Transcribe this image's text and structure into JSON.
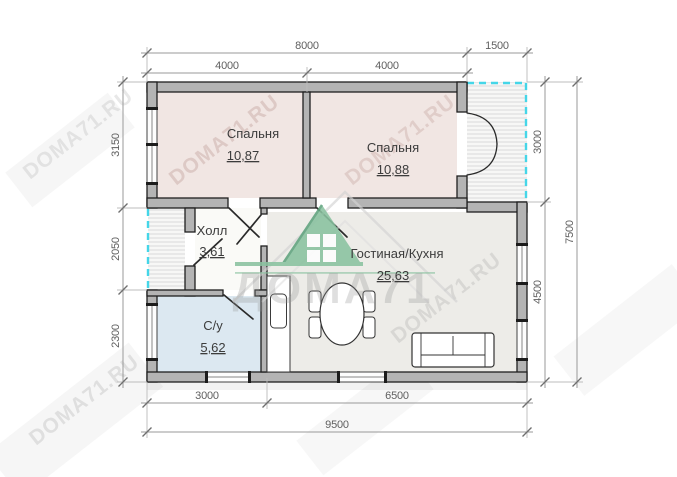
{
  "watermark": {
    "brand": "ДОМА71",
    "site": "DOMA71.RU"
  },
  "rooms": {
    "bedroom1": {
      "name": "Спальня",
      "area": "10,87"
    },
    "bedroom2": {
      "name": "Спальня",
      "area": "10,88"
    },
    "hall": {
      "name": "Холл",
      "area": "3,61"
    },
    "bathroom": {
      "name": "С/у",
      "area": "5,62"
    },
    "living": {
      "name": "Гостиная/Кухня",
      "area": "25,63"
    }
  },
  "dims": {
    "top_main": "8000",
    "top_terrace": "1500",
    "top_b1": "4000",
    "top_b2": "4000",
    "left_bedroom": "3150",
    "left_porch": "2050",
    "left_bathroom": "2300",
    "right_terrace": "3000",
    "right_living": "4500",
    "right_total": "7500",
    "bottom_bath": "3000",
    "bottom_living": "6500",
    "bottom_total": "9500"
  },
  "colors": {
    "wall": "#b4b4b4",
    "wall_outline": "#1f1f1f",
    "bedroom_fill": "#f1e6e3",
    "bathroom_fill": "#dce8f1",
    "living_fill": "#edece8",
    "hall_fill": "#fafaf7",
    "open_area_dash": "#45d6e8",
    "logo_green": "#8ac2a0",
    "dimension_text": "#5f5f5f"
  }
}
